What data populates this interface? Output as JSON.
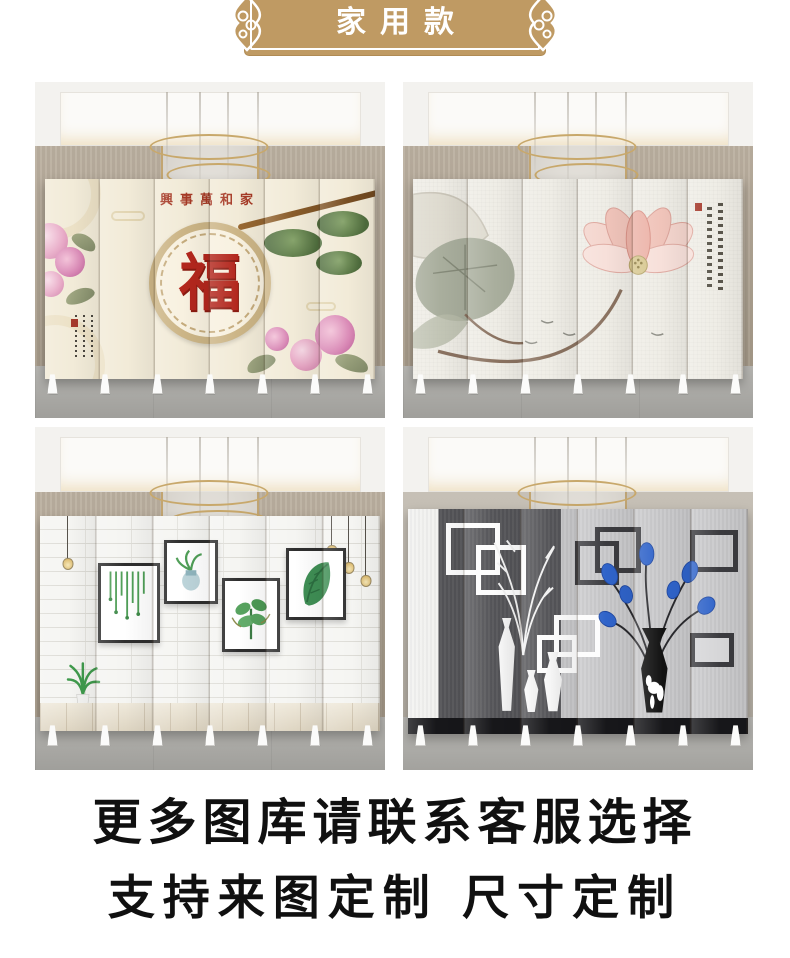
{
  "header": {
    "label": "家用款",
    "banner_color": "#bf9a63",
    "text_color": "#ffffff"
  },
  "gallery": {
    "items": [
      {
        "name": "fu-blessing-screen",
        "overlay_title": "興事萬和家",
        "center_glyph": "福",
        "glyph_color": "#b3271d",
        "title_color": "#a63a26",
        "panel_count": 6
      },
      {
        "name": "lotus-ink-screen",
        "seal_color": "#a5392b",
        "panel_count": 6
      },
      {
        "name": "white-brick-gallery-screen",
        "frame_count": 4,
        "panel_count": 6
      },
      {
        "name": "modern-vase-screen",
        "flower_color": "#2f63c9",
        "panel_count": 6
      }
    ]
  },
  "footer": {
    "line1": "更多图库请联系客服选择",
    "line2": "支持来图定制 尺寸定制",
    "text_color": "#101010"
  },
  "colors": {
    "banner_tan": "#bf9a63",
    "fu_red": "#b3271d",
    "seal_red": "#a5392b",
    "flower_blue": "#2f63c9",
    "room_wall": "#b1a594",
    "room_floor": "#a8a7a3"
  }
}
